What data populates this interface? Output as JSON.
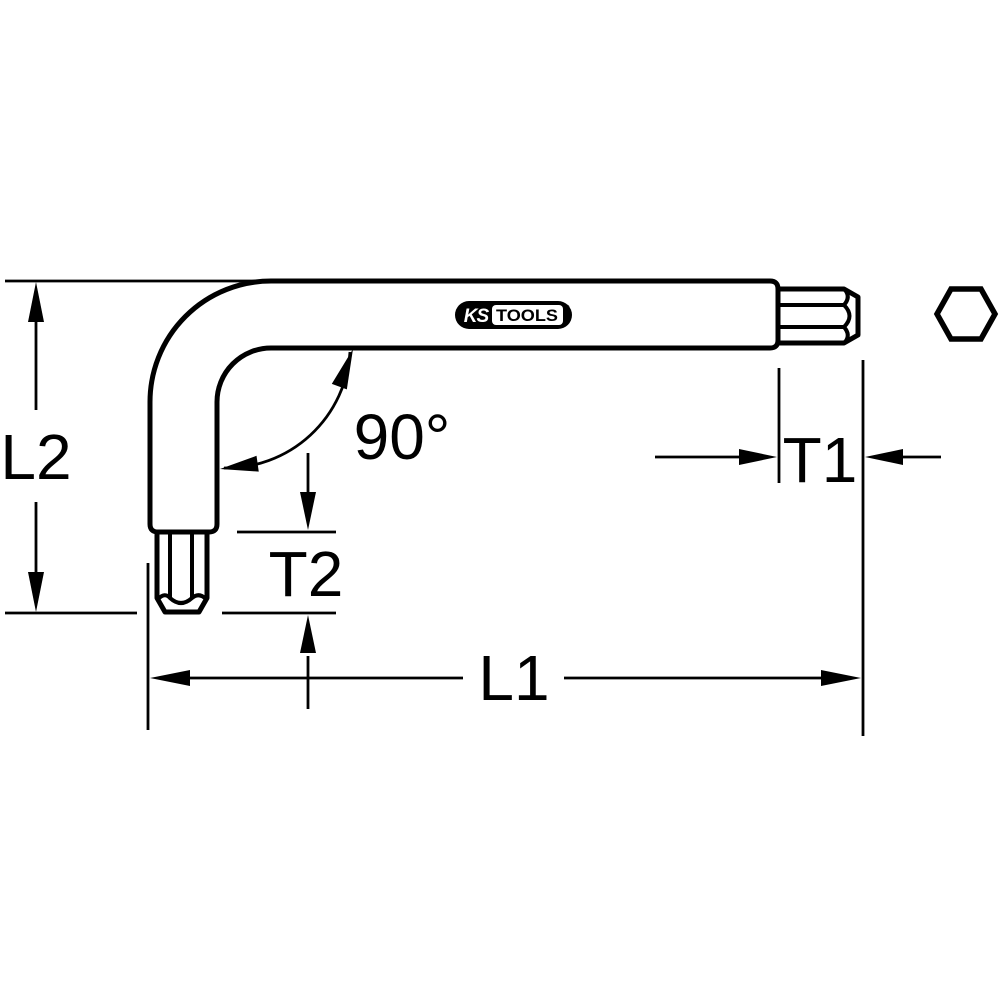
{
  "colors": {
    "line": "#000000",
    "background": "#ffffff"
  },
  "labels": {
    "l1": "L1",
    "l2": "L2",
    "t1": "T1",
    "t2": "T2",
    "angle": "90°"
  },
  "logo": {
    "ks": "KS",
    "tools": "TOOLS",
    "registered": "®"
  },
  "icons": {
    "hex_cross_section": "flat-top hexagon outline"
  }
}
